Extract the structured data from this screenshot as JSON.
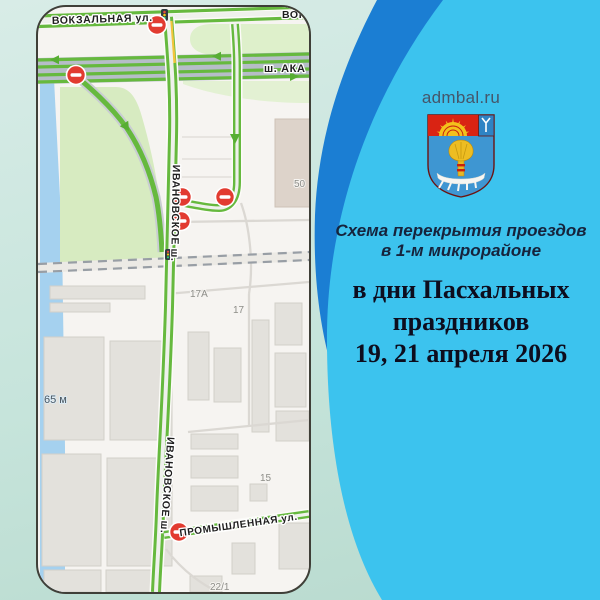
{
  "site": {
    "domain": "admbal.ru"
  },
  "heading": {
    "line1": "Схема перекрытия проездов",
    "line2": "в 1-м микрорайоне"
  },
  "dates": {
    "line1": "в дни Пасхальных",
    "line2": "праздников",
    "line3": "19, 21 апреля 2026"
  },
  "map": {
    "streets": {
      "vokzalnaya": "ВОКЗАЛЬНАЯ ул.",
      "vokzalnaya_cut": "ВОК",
      "akademika": "ш. АКА",
      "ivanovskoe": "ИВАНОВСКОЕ ш.",
      "promyshlennaya": "ПРОМЫШЛЕННАЯ ул."
    },
    "buildings": {
      "b50": "50",
      "b17a": "17А",
      "b17": "17",
      "b15": "15",
      "b22": "22/1"
    },
    "scale_label": "65 м"
  },
  "colors": {
    "accent_blue": "#3cc3ee",
    "band_blue": "#1b7ed3",
    "bg_mint": "#cde9e0",
    "sign_red": "#e23b30",
    "road_green": "#66b93e",
    "heading_navy": "#16233c",
    "dates_ink": "#0d0d1e"
  }
}
